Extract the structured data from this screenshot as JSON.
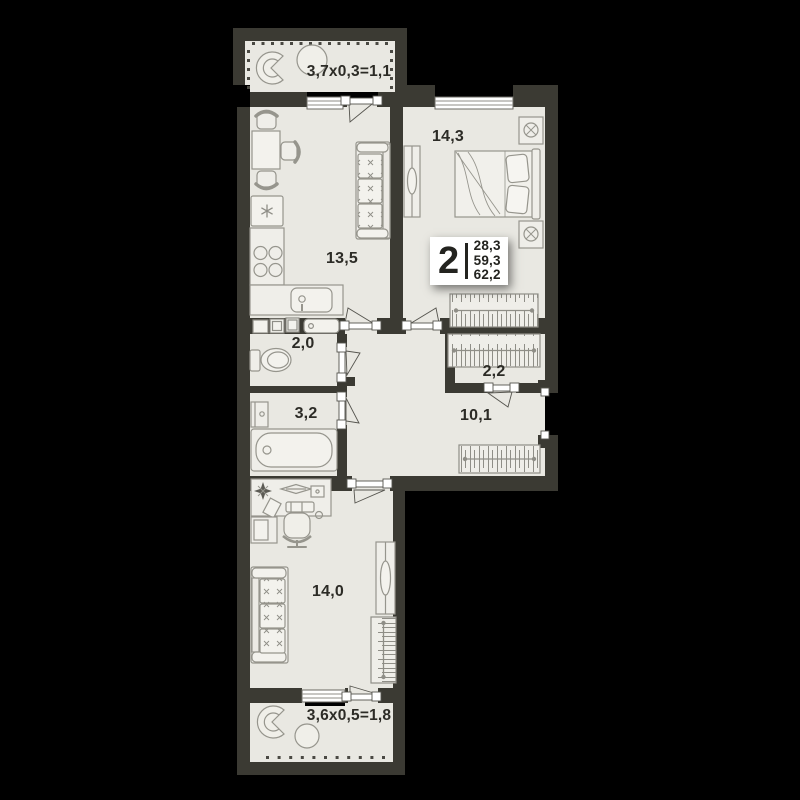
{
  "plan": {
    "badge": {
      "rooms_count": "2",
      "areas": [
        "28,3",
        "59,3",
        "62,2"
      ]
    },
    "rooms": {
      "balcony_top": {
        "label": "3,7х0,3=1,1"
      },
      "bedroom": {
        "label": "14,3"
      },
      "kitchen_living": {
        "label": "13,5"
      },
      "wc": {
        "label": "2,0"
      },
      "closet": {
        "label": "2,2"
      },
      "bathroom": {
        "label": "3,2"
      },
      "hallway": {
        "label": "10,1"
      },
      "room": {
        "label": "14,0"
      },
      "balcony_bottom": {
        "label": "3,6х0,5=1,8"
      }
    },
    "colors": {
      "background": "#000000",
      "wall": "#3b3a33",
      "floor": "#e9e8e2",
      "furniture_stroke": "#96958d",
      "text": "#2c2b26",
      "badge_bg": "#ffffff"
    }
  }
}
